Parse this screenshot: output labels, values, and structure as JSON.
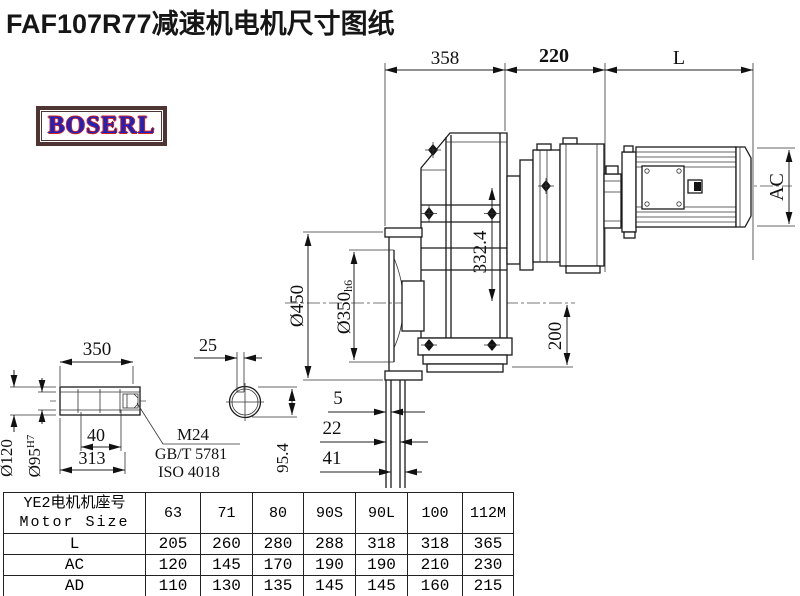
{
  "title": "FAF107R77减速机电机尺寸图纸",
  "logo": {
    "text": "BOSERL"
  },
  "dims": {
    "top_left": "358",
    "top_mid": "220",
    "top_right": "L",
    "motor_height": "AC",
    "flange_od": "Ø450",
    "pilot_main": "Ø350",
    "pilot_suffix": "h6",
    "axis_offset": "332.4",
    "foot_height": "200",
    "gap_5": "5",
    "gap_22": "22",
    "gap_41": "41",
    "shaft_len": "350",
    "key_width": "25",
    "shaft_od": "Ø120",
    "bore_main": "Ø95",
    "bore_suffix": "H7",
    "hole_depth": "40",
    "usable_len": "313",
    "thread_line1": "M24",
    "thread_line2": "GB/T 5781",
    "thread_line3": "ISO 4018",
    "key_height": "95.4"
  },
  "table": {
    "header_cn": "YE2电机机座号",
    "header_en": "Motor Size",
    "sizes": [
      "63",
      "71",
      "80",
      "90S",
      "90L",
      "100",
      "112M"
    ],
    "rows": [
      {
        "label": "L",
        "values": [
          "205",
          "260",
          "280",
          "288",
          "318",
          "318",
          "365"
        ]
      },
      {
        "label": "AC",
        "values": [
          "120",
          "145",
          "170",
          "190",
          "190",
          "210",
          "230"
        ]
      },
      {
        "label": "AD",
        "values": [
          "110",
          "130",
          "135",
          "145",
          "145",
          "160",
          "215"
        ]
      }
    ]
  },
  "colors": {
    "line": "#1a1a1a",
    "logo_border": "#4f3434",
    "logo_text": "#2121bd",
    "logo_outline": "#cc2222"
  }
}
